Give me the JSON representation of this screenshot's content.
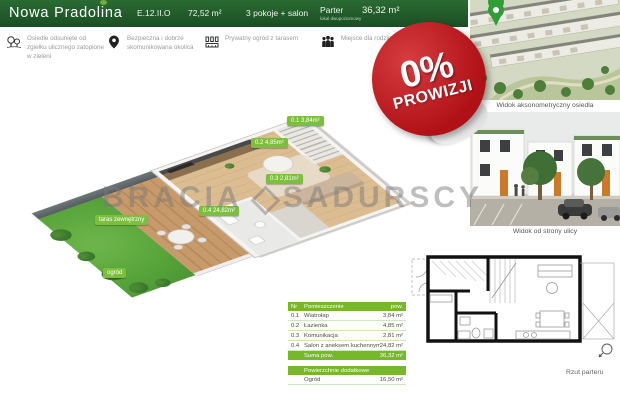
{
  "colors": {
    "header_green": "#1f5a28",
    "accent_green": "#76b82a",
    "badge_red": "#b01116"
  },
  "brand": {
    "name": "Nowa Pradolina"
  },
  "header": {
    "unit_code": "E.12.II.O",
    "total_area": "72,52 m²",
    "rooms": "3 pokoje + salon",
    "level": "Parter",
    "level_note": "lokal dwupoziomowy",
    "level_area": "36,32 m²"
  },
  "features": [
    {
      "icon": "trees-icon",
      "text": "Osiedle odsunięte od zgiełku ulicznego zatopione w zieleni"
    },
    {
      "icon": "map-pin-icon",
      "text": "Bezpieczna i dobrze skomunikowana okolica"
    },
    {
      "icon": "fence-icon",
      "text": "Prywatny ogród z tarasem"
    },
    {
      "icon": "family-icon",
      "text": "Miejsce dla rodzin"
    }
  ],
  "badge": {
    "percent": "0%",
    "label": "PROWIZJI"
  },
  "watermark": {
    "word1": "BRACIA",
    "word2": "SADURSCY"
  },
  "plan3d": {
    "labels": [
      {
        "text": "0.1  3,84m²",
        "x": 287,
        "y": 116
      },
      {
        "text": "0.2  4,85m²",
        "x": 251,
        "y": 138
      },
      {
        "text": "0.3  2,81m²",
        "x": 266,
        "y": 174
      },
      {
        "text": "0.4  24,82m²",
        "x": 199,
        "y": 206
      },
      {
        "text": "taras zewnętrzny",
        "x": 95,
        "y": 215
      },
      {
        "text": "ogród",
        "x": 103,
        "y": 268
      }
    ]
  },
  "photos": {
    "photo1_caption": "Widok aksonometryczny osiedla",
    "photo2_caption": "Widok od strony ulicy"
  },
  "plan2d": {
    "caption": "Rzut parteru"
  },
  "rooms_table": {
    "headers": {
      "nr": "Nr",
      "name": "Pomieszczenie",
      "area": "pow."
    },
    "rows": [
      {
        "nr": "0.1",
        "name": "Wiatrołap",
        "area": "3,84 m²"
      },
      {
        "nr": "0.2",
        "name": "Łazienka",
        "area": "4,85 m²"
      },
      {
        "nr": "0.3",
        "name": "Komunikacja",
        "area": "2,81 m²"
      },
      {
        "nr": "0.4",
        "name": "Salon z aneksem kuchennym",
        "area": "24,82 m²"
      }
    ],
    "total": {
      "label": "Suma pow.",
      "area": "36,32 m²"
    },
    "extra_header": "Powierzchnie dodatkowe",
    "extra_rows": [
      {
        "name": "Ogród",
        "area": "16,50 m²"
      }
    ]
  }
}
